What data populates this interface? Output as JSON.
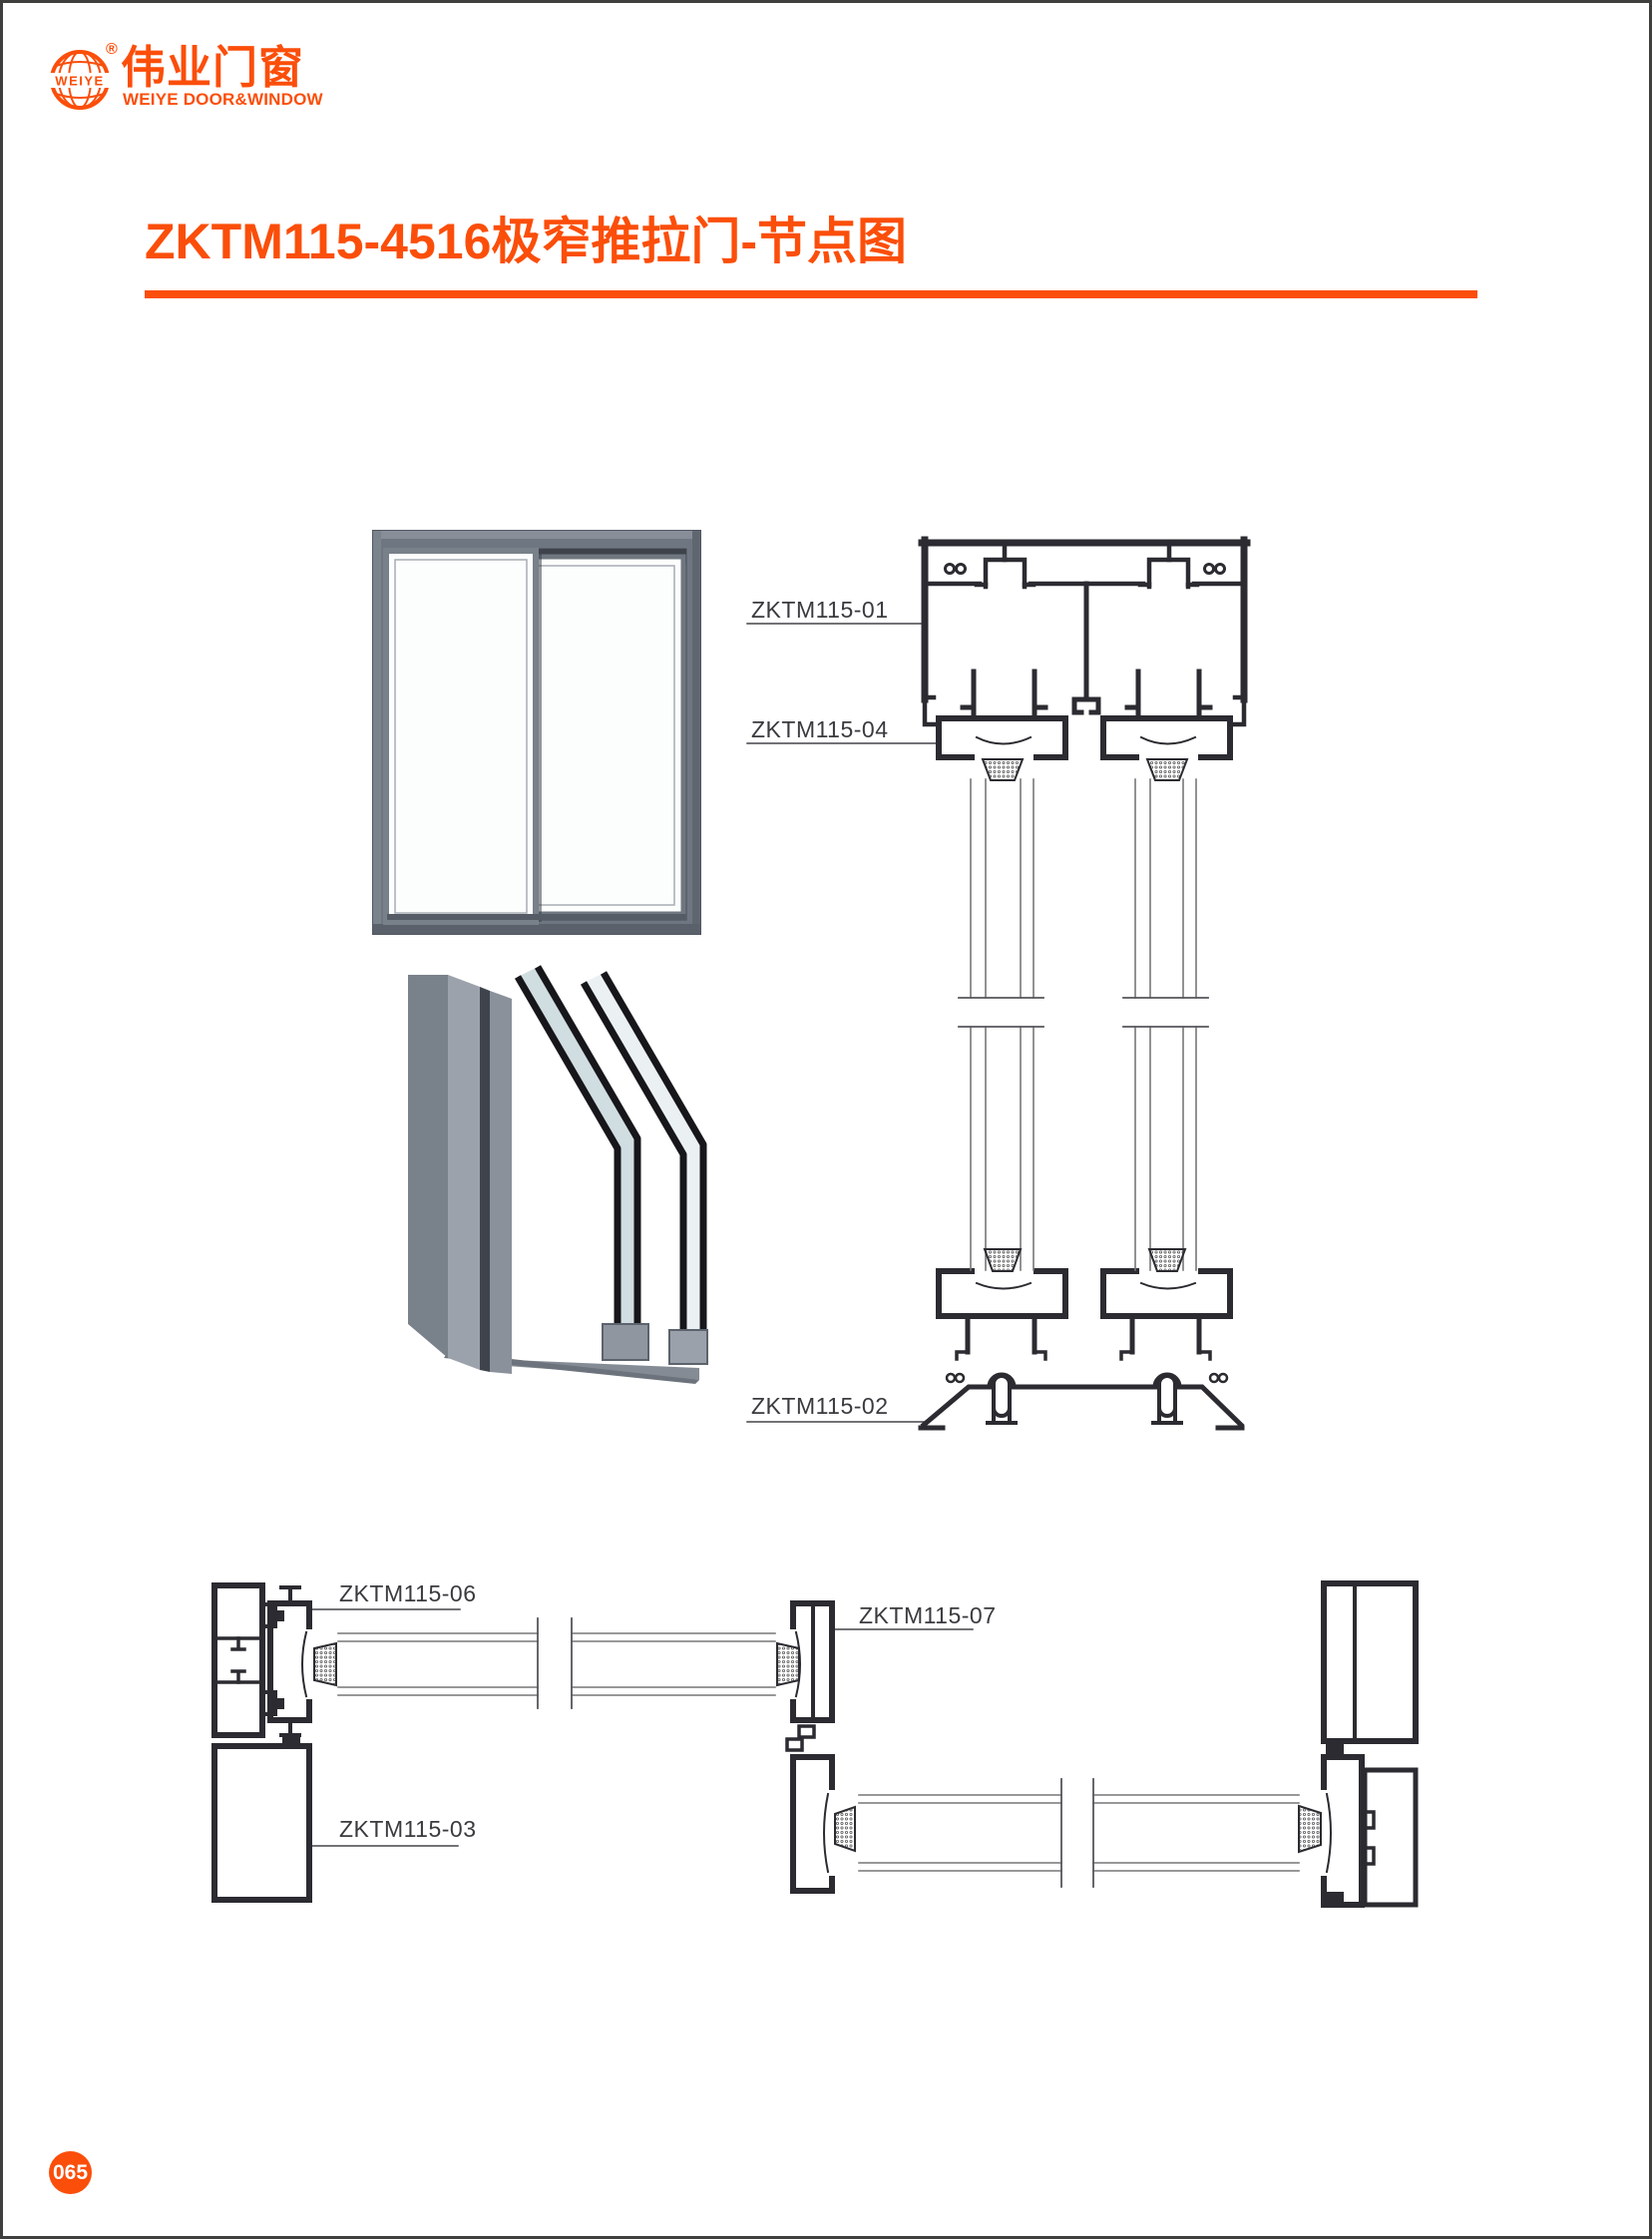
{
  "page": {
    "number": "065"
  },
  "logo": {
    "globe_text": "WEIYE",
    "registered_mark": "®",
    "chinese_name": "伟业门窗",
    "english_name": "WEIYE DOOR&WINDOW"
  },
  "header": {
    "title": "ZKTM115-4516极窄推拉门-节点图"
  },
  "sections": {
    "vertical": {
      "labels": [
        "ZKTM115-01",
        "ZKTM115-04",
        "ZKTM115-02"
      ]
    },
    "horizontal": {
      "labels": [
        "ZKTM115-06",
        "ZKTM115-07",
        "ZKTM115-03"
      ]
    }
  },
  "colors": {
    "accent": "#FB4E0A",
    "drawing_line": "#2B2B31",
    "thin_line": "#777777",
    "label_text": "#3A3A3F",
    "render_frame_gray": "#6E7681"
  }
}
